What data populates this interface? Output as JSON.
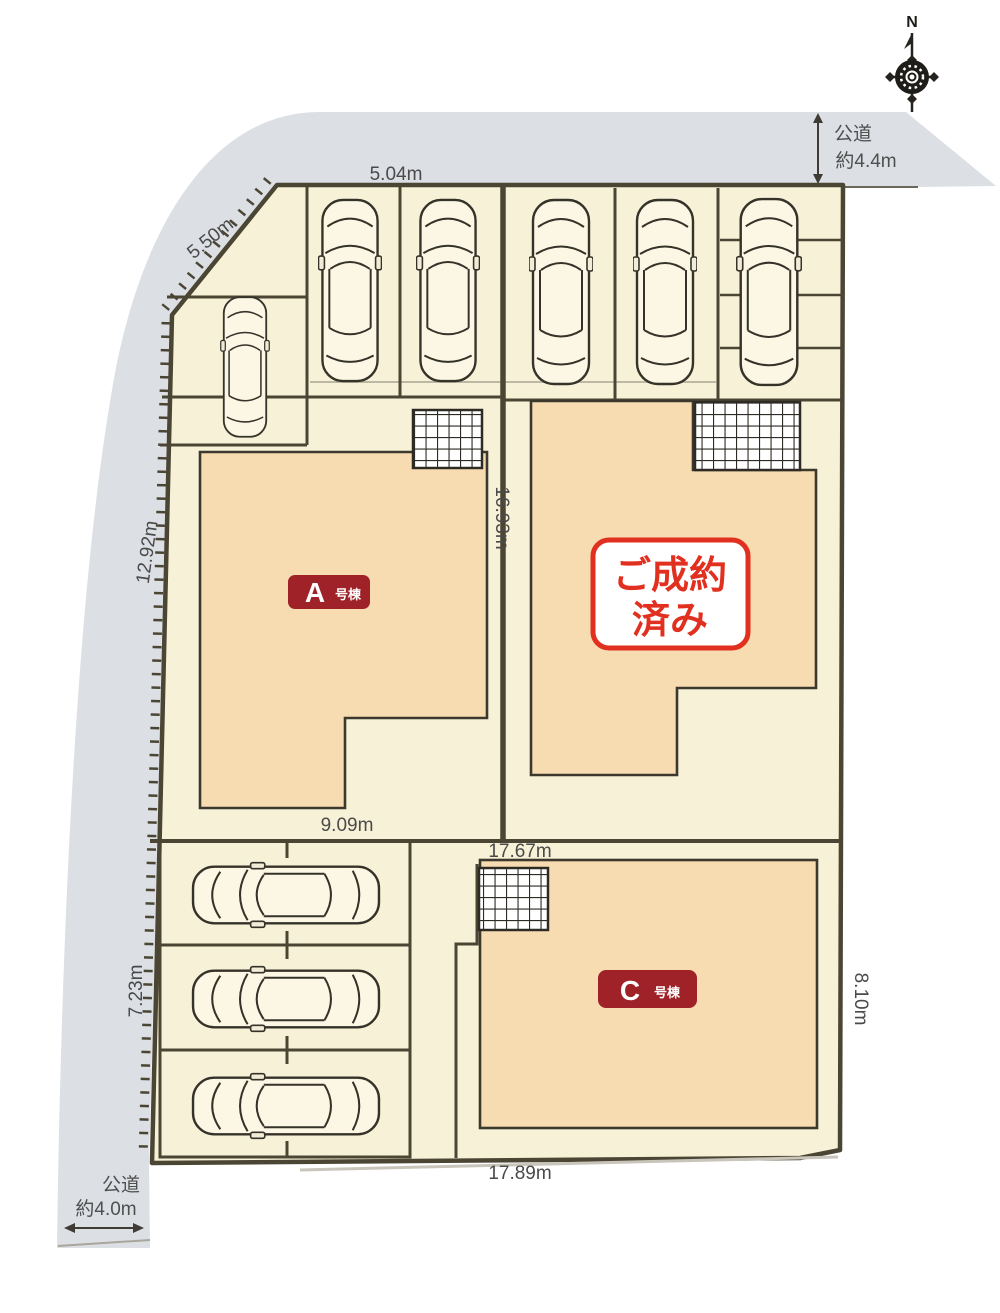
{
  "site": {
    "compass": {
      "n": "N"
    },
    "roads": {
      "top": {
        "label": "公道",
        "width": "約4.4m"
      },
      "bottom": {
        "label": "公道",
        "width": "約4.0m"
      }
    },
    "dims": {
      "top": "5.04m",
      "diag": "5.50m",
      "left_up": "12.92m",
      "mid": "16.93m",
      "a_width": "9.09m",
      "c_top": "17.67m",
      "left_low": "7.23m",
      "right_low": "8.10m",
      "bottom": "17.89m"
    },
    "buildings": {
      "a": {
        "letter": "A",
        "type": "号棟"
      },
      "b": {
        "line1": "ご成約",
        "line2": "済み"
      },
      "c": {
        "letter": "C",
        "type": "号棟"
      }
    },
    "colors": {
      "road": "#dcdfe4",
      "plot": "#f7f2d7",
      "building": "#f8dcb1",
      "outline": "#4b4534",
      "label_red": "#9e2227",
      "stamp_red": "#e1301f",
      "text": "#4a4a4a"
    },
    "icons": {
      "compass": "compass-rose",
      "car": "car-top-view",
      "porch": "entry-porch-grid"
    }
  }
}
